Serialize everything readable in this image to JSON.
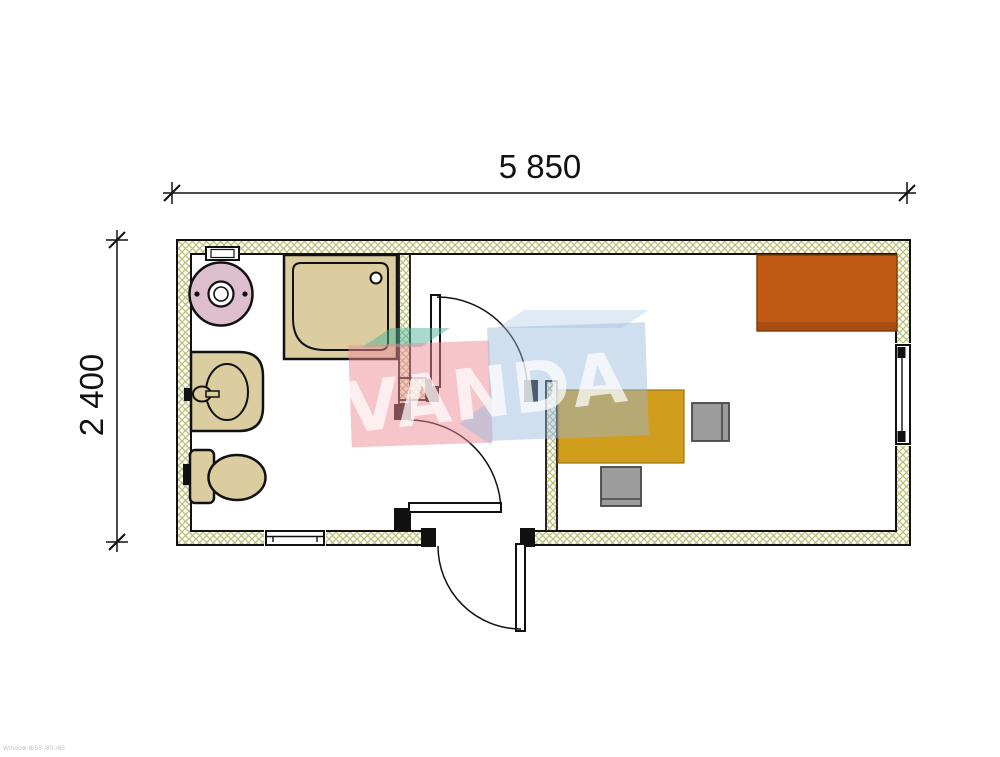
{
  "dimensions": {
    "width_label": "5 850",
    "height_label": "2 400"
  },
  "watermark": {
    "text": "VANDA",
    "pink": "#ee8c96",
    "blue": "#96b9dd",
    "teal": "#50b49e",
    "letter_color": "#ffffff"
  },
  "plan": {
    "wall_hatch_color": "#b9c075",
    "fixtures": {
      "water_heater": {
        "color": "#dcbecd"
      },
      "shower": {
        "color": "#dbcda0"
      },
      "sink": {
        "color": "#dbcda0"
      },
      "toilet": {
        "color": "#dbcda0"
      }
    },
    "furniture": {
      "desk": {
        "color": "#d19d1d"
      },
      "chair": {
        "color": "#9c9c9c"
      },
      "cabinet": {
        "color": "#c05a14",
        "accent": "#a84c10"
      }
    }
  },
  "footer": {
    "fineprint": "Window 8/55 /85 /85"
  }
}
